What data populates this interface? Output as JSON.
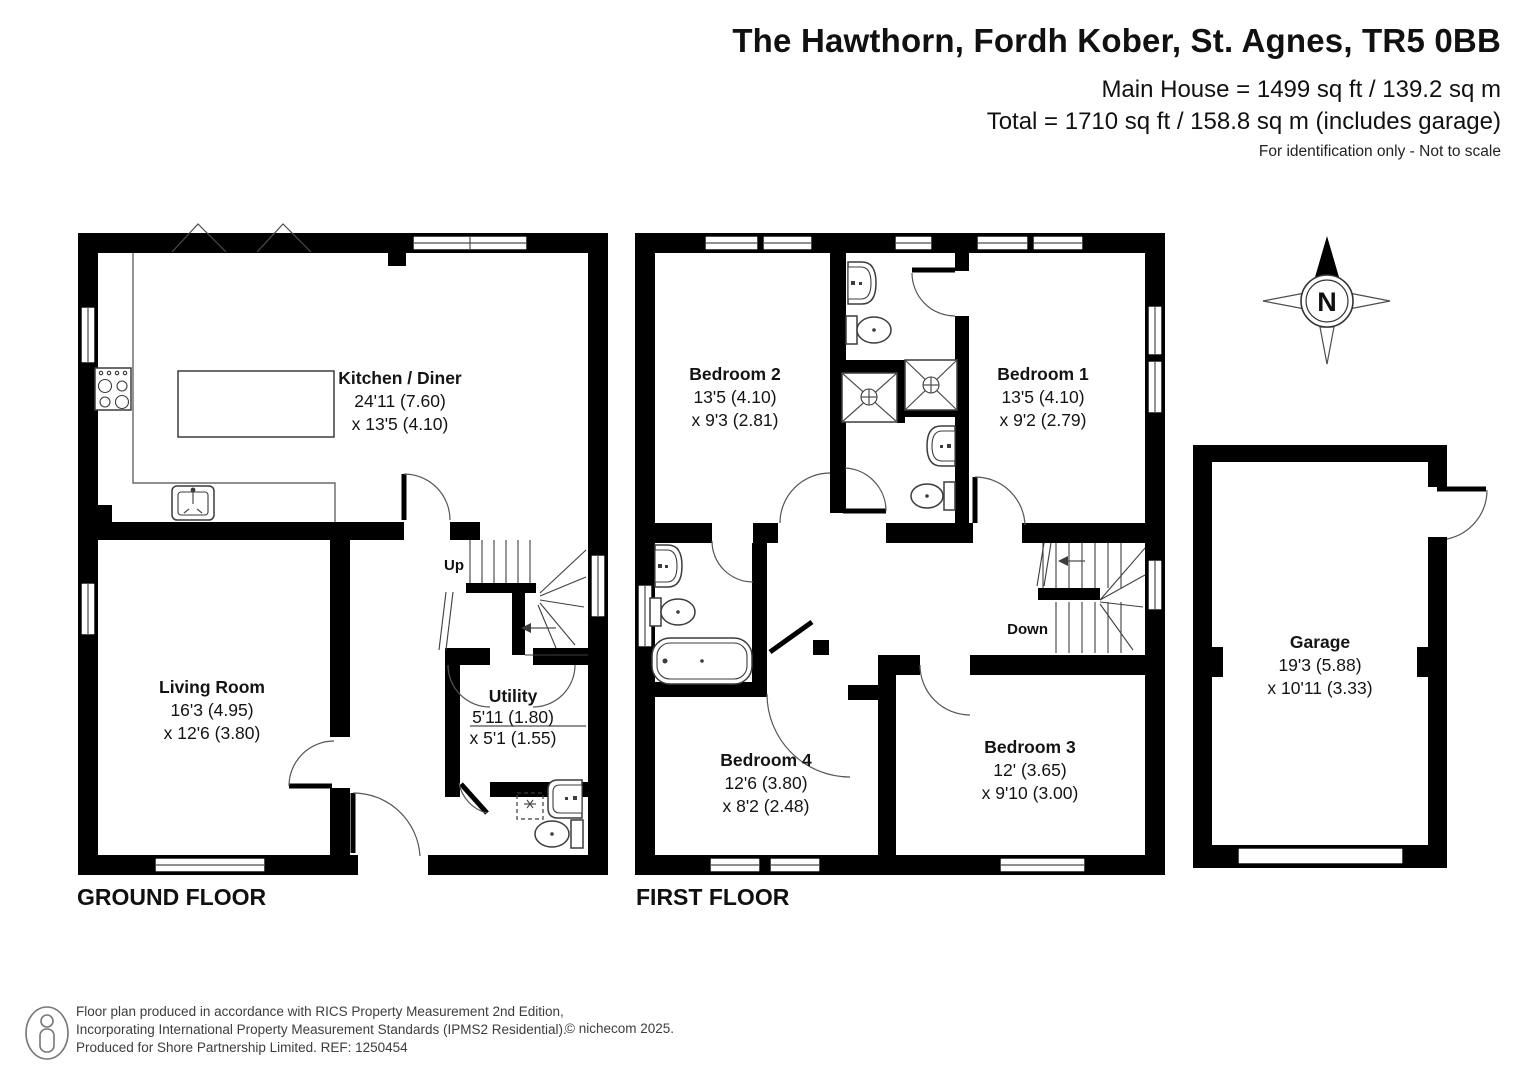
{
  "title": {
    "address": "The Hawthorn, Fordh Kober, St. Agnes, TR5 0BB",
    "main_house": "Main House = 1499 sq ft / 139.2 sq m",
    "total": "Total = 1710 sq ft / 158.8 sq m (includes garage)",
    "disclaimer": "For identification only - Not to scale"
  },
  "floors": {
    "ground_label": "GROUND FLOOR",
    "first_label": "FIRST FLOOR"
  },
  "rooms": {
    "kitchen_diner": {
      "name": "Kitchen / Diner",
      "dim1": "24'11 (7.60)",
      "dim2": "x 13'5 (4.10)"
    },
    "living_room": {
      "name": "Living Room",
      "dim1": "16'3 (4.95)",
      "dim2": "x 12'6 (3.80)"
    },
    "utility": {
      "name": "Utility",
      "dim1": "5'11 (1.80)",
      "dim2": "x 5'1 (1.55)"
    },
    "bedroom1": {
      "name": "Bedroom 1",
      "dim1": "13'5 (4.10)",
      "dim2": "x 9'2 (2.79)"
    },
    "bedroom2": {
      "name": "Bedroom 2",
      "dim1": "13'5 (4.10)",
      "dim2": "x 9'3 (2.81)"
    },
    "bedroom3": {
      "name": "Bedroom 3",
      "dim1": "12' (3.65)",
      "dim2": "x 9'10 (3.00)"
    },
    "bedroom4": {
      "name": "Bedroom 4",
      "dim1": "12'6 (3.80)",
      "dim2": "x 8'2 (2.48)"
    },
    "garage": {
      "name": "Garage",
      "dim1": "19'3 (5.88)",
      "dim2": "x 10'11 (3.33)"
    }
  },
  "stairs": {
    "up_label": "Up",
    "down_label": "Down"
  },
  "compass": {
    "north_label": "N"
  },
  "footer": {
    "line1": "Floor plan produced in accordance with RICS Property Measurement 2nd Edition,",
    "line2": "Incorporating International Property Measurement Standards (IPMS2 Residential).",
    "line3": "Produced for Shore Partnership Limited.   REF: 1250454",
    "copyright": "© nichecom 2025."
  },
  "colors": {
    "wall": "#000000",
    "background": "#ffffff",
    "fixture_line": "#3c3c3c",
    "text": "#141414"
  }
}
